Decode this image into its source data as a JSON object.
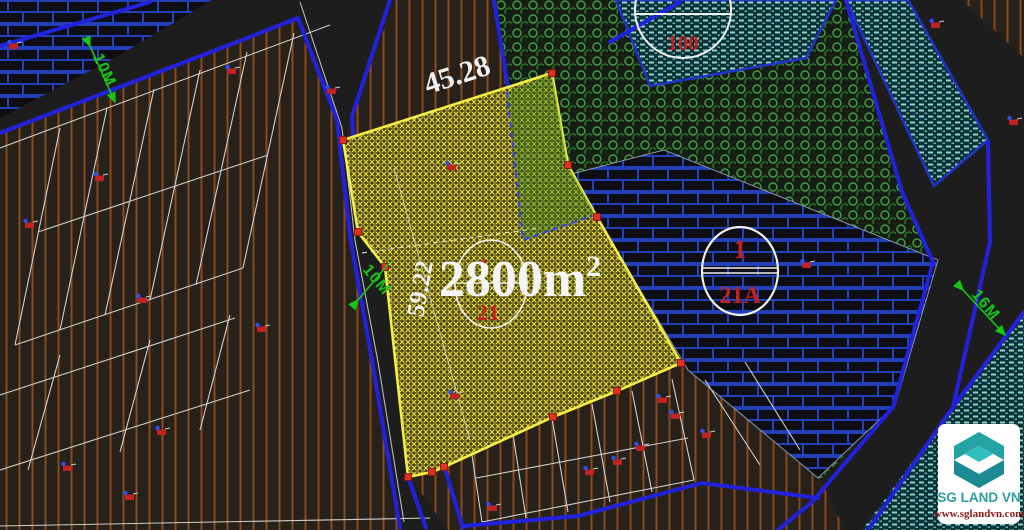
{
  "scene": {
    "type": "cadastral-cad-map-view"
  },
  "parcel": {
    "area_main": "2800m",
    "area_sup": "2",
    "width_dim": "45.28",
    "side_dim": "59.22",
    "lot_circle_top": "1",
    "lot_circle_bottom": "21"
  },
  "roads": {
    "topleft_width": "10M",
    "left_width": "10M",
    "right_width": "16M"
  },
  "blocks": {
    "top_circle_label": "100",
    "right_circle_top": "1",
    "right_circle_bottom": "21A"
  },
  "logo": {
    "brand": "SG LAND VN",
    "website": "www.sglandvn.com"
  },
  "icons": {
    "house_marker": "red house symbol with blue dot",
    "vertex_handle": "red square grip",
    "width_arrow": "green dimension arrow"
  },
  "colors": {
    "background": "#1d1d1d",
    "parcel_fill": "#d8cd3e",
    "parcel_border": "#f5ef45",
    "road_line": "#2222dd",
    "brick_blue": "#2547d0",
    "green_circle": "#3f9c3f",
    "teal_hatch": "#8fd4cf",
    "brown_hatch": "#8a4a1e",
    "dim_text": "#f0f0f0",
    "label_green": "#17c517",
    "lot_red": "#c42222",
    "logo_teal": "#2aa0a0",
    "logo_red": "#8b1616"
  }
}
